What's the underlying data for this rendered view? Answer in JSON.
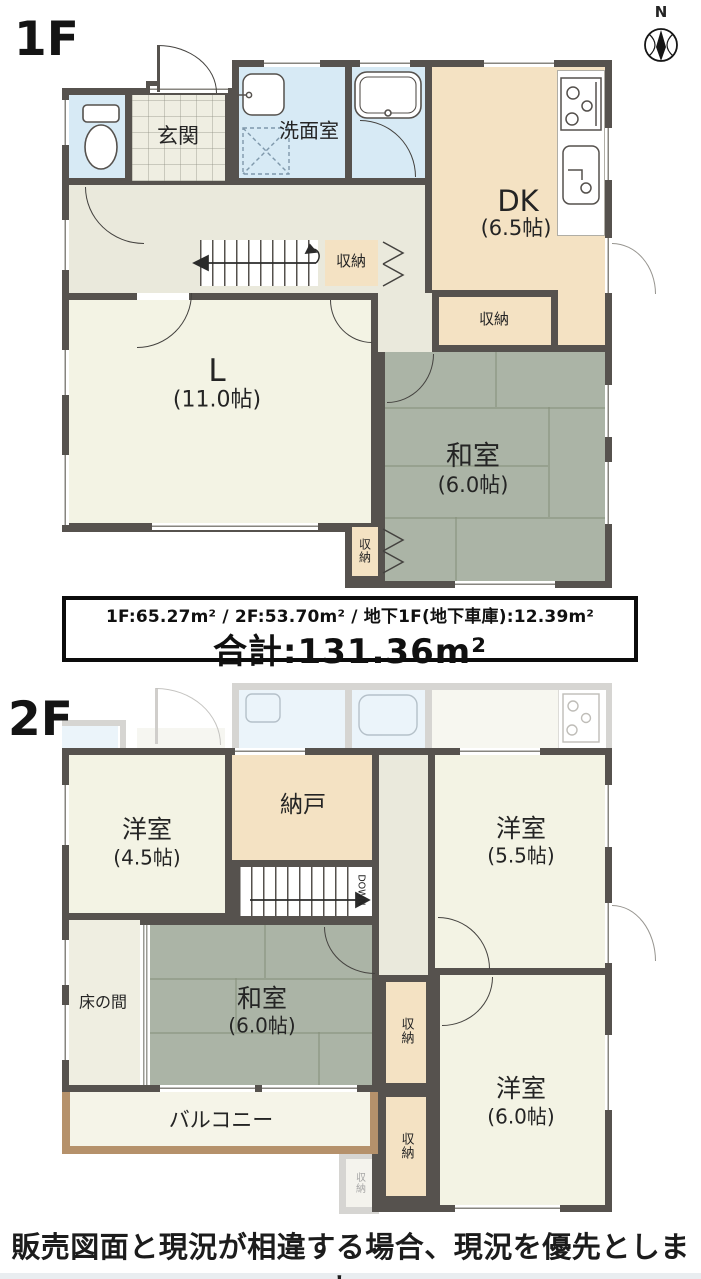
{
  "colors": {
    "wall": "#56524e",
    "tatami_green": "#abb4a6",
    "storage_beige": "#f4e2c3",
    "water_blue": "#d7eaf5",
    "room_cream": "#f3f3e4",
    "hall_cream": "#eae9dc",
    "balcony_trim": "#b5916b"
  },
  "compass": {
    "label": "N"
  },
  "floor1": {
    "label": "1F",
    "rooms": {
      "genkan": "玄関",
      "senmenshitsu": "洗面室",
      "dk": "DK",
      "dk_size": "(6.5帖)",
      "living": "L",
      "living_size": "(11.0帖)",
      "washitsu": "和室",
      "washitsu_size": "(6.0帖)"
    },
    "storages": {
      "hall": "収納",
      "dk_side": "収納",
      "washitsu_side": "収納"
    }
  },
  "floor2": {
    "label": "2F",
    "rooms": {
      "yoshitsu_45": "洋室",
      "yoshitsu_45_size": "(4.5帖)",
      "nando": "納戸",
      "yoshitsu_55": "洋室",
      "yoshitsu_55_size": "(5.5帖)",
      "tokonoma": "床の間",
      "washitsu": "和室",
      "washitsu_size": "(6.0帖)",
      "yoshitsu_60": "洋室",
      "yoshitsu_60_size": "(6.0帖)",
      "balcony": "バルコニー"
    },
    "storages": {
      "a": "収納",
      "b": "収納",
      "ghost": "収納"
    },
    "stairs_down_label": "DOWN"
  },
  "area_summary": {
    "breakdown": "1F:65.27m²  /  2F:53.70m²  /  地下1F(地下車庫):12.39m²",
    "total": "合計:131.36m²"
  },
  "footer_note": "販売図面と現況が相違する場合、現況を優先とします。"
}
